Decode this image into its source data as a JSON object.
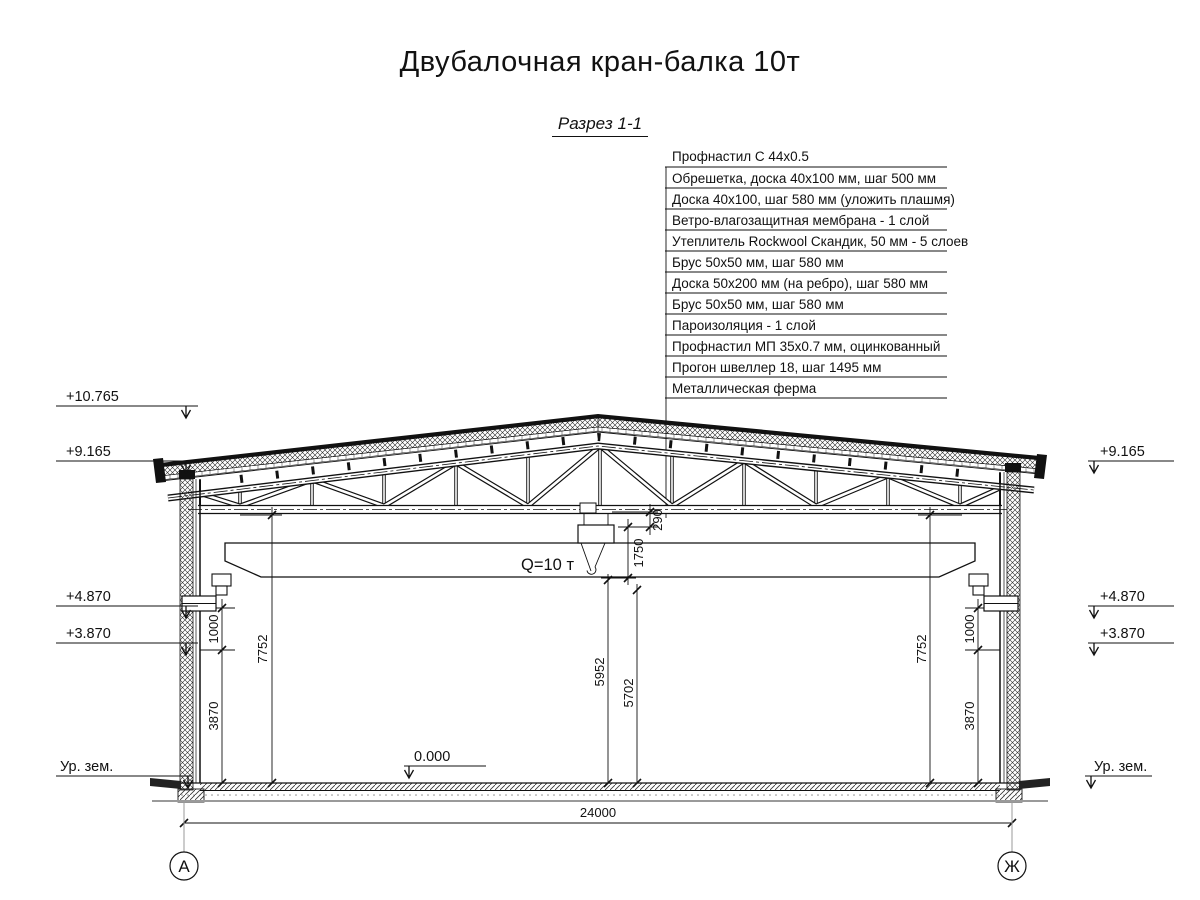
{
  "title": "Двубалочная кран-балка 10т",
  "section_label": "Разрез 1-1",
  "roof_layers": [
    "Профнастил С 44х0.5",
    "Обрешетка, доска 40х100 мм, шаг 500 мм",
    "Доска 40х100, шаг 580 мм (уложить плашмя)",
    "Ветро-влагозащитная мембрана - 1 слой",
    "Утеплитель Rockwool Скандик, 50 мм - 5 слоев",
    "Брус 50х50 мм, шаг 580 мм",
    "Доска 50х200 мм (на ребро), шаг 580 мм",
    "Брус 50х50 мм, шаг 580 мм",
    "Пароизоляция - 1 слой",
    "Профнастил МП 35х0.7 мм, оцинкованный",
    "Прогон швеллер 18, шаг 1495 мм",
    "Металлическая ферма"
  ],
  "elevations": {
    "ridge": "+10.765",
    "eave": "+9.165",
    "rail_top": "+4.870",
    "console": "+3.870",
    "ground": "Ур. зем.",
    "floor": "0.000"
  },
  "dims": {
    "span": "24000",
    "d290": "290",
    "d1750": "1750",
    "d5952": "5952",
    "d5702": "5702",
    "d1000": "1000",
    "d3870": "3870",
    "d7752": "7752"
  },
  "crane": {
    "capacity": "Q=10 т"
  },
  "axes": {
    "left": "А",
    "right": "Ж"
  },
  "colors": {
    "line": "#111111",
    "ground": "#9a9a9a",
    "hatch": "#333333"
  }
}
